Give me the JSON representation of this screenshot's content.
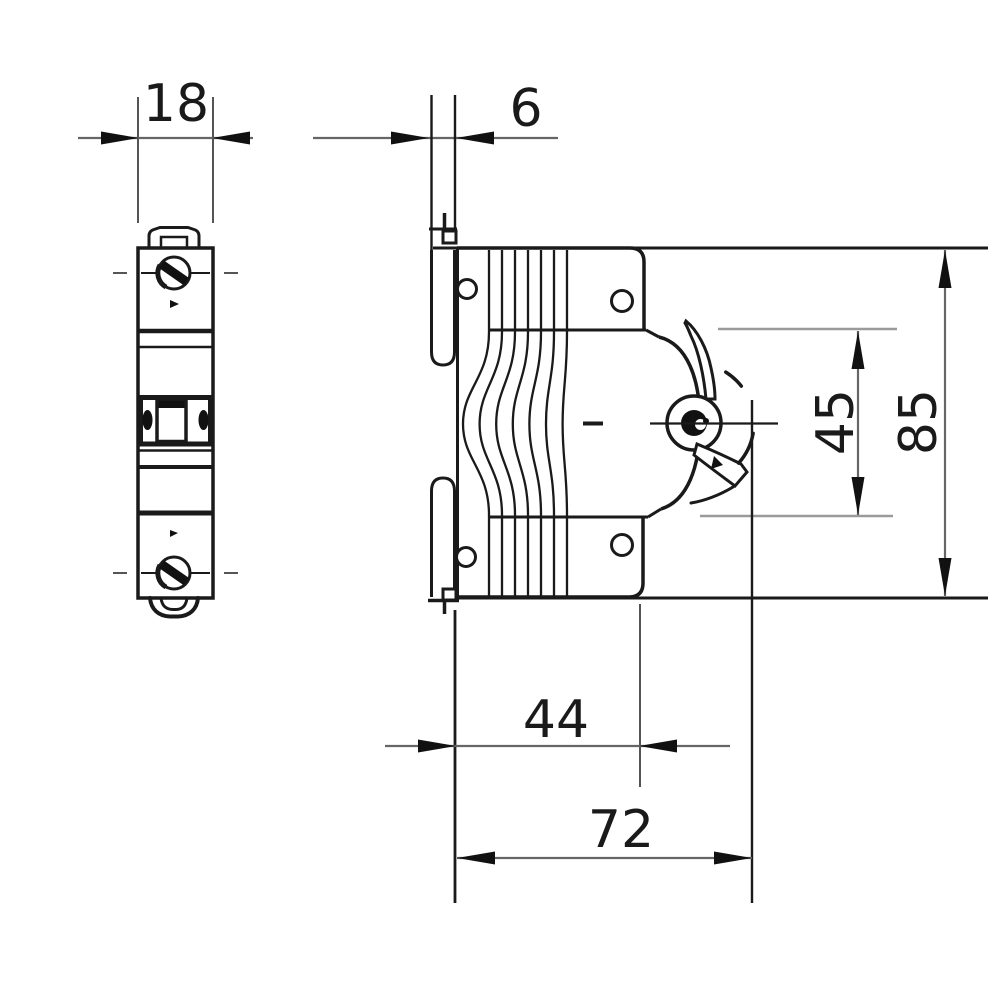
{
  "drawing": {
    "background": "#ffffff",
    "ink_color": "#1a1a1a",
    "dim_line_color": "#666666",
    "ext_line_color": "#9a9a9a",
    "views": {
      "front": {
        "width_label": "18"
      },
      "side": {
        "rail_depth_label": "6",
        "handle_zone_height_label": "45",
        "overall_height_label": "85",
        "body_depth_label": "44",
        "overall_depth_label": "72"
      }
    }
  }
}
